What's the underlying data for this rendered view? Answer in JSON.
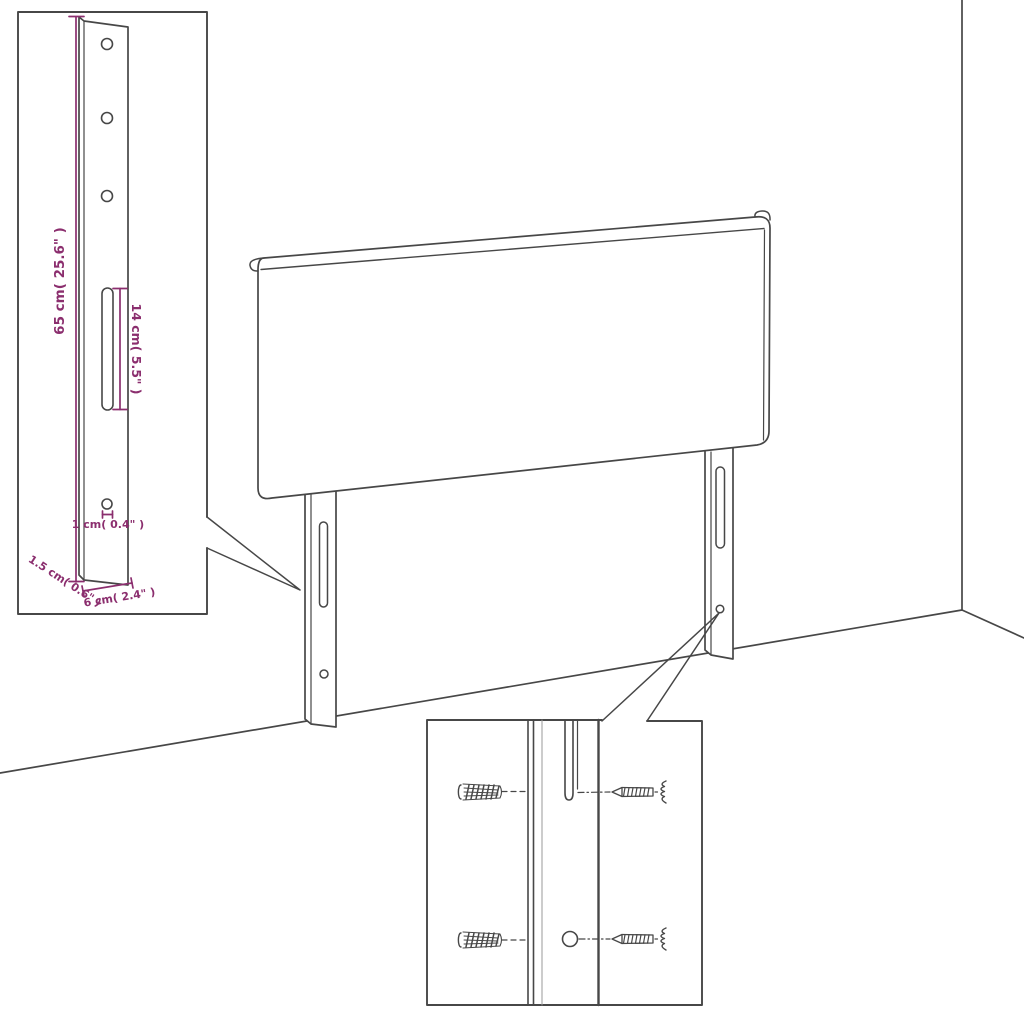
{
  "colors": {
    "line": "#474747",
    "line_light": "#8a8a8a",
    "dimension": "#8b2e6e",
    "background": "#ffffff"
  },
  "insets": {
    "leg_detail": {
      "dimensions": {
        "height": "65 cm( 25.6\" )",
        "slot_length": "14 cm( 5.5\" )",
        "hole_diameter": "1 cm( 0.4\" )",
        "depth": "1.5 cm( 0.6\" )",
        "width": "6 cm( 2.4\" )"
      }
    }
  }
}
